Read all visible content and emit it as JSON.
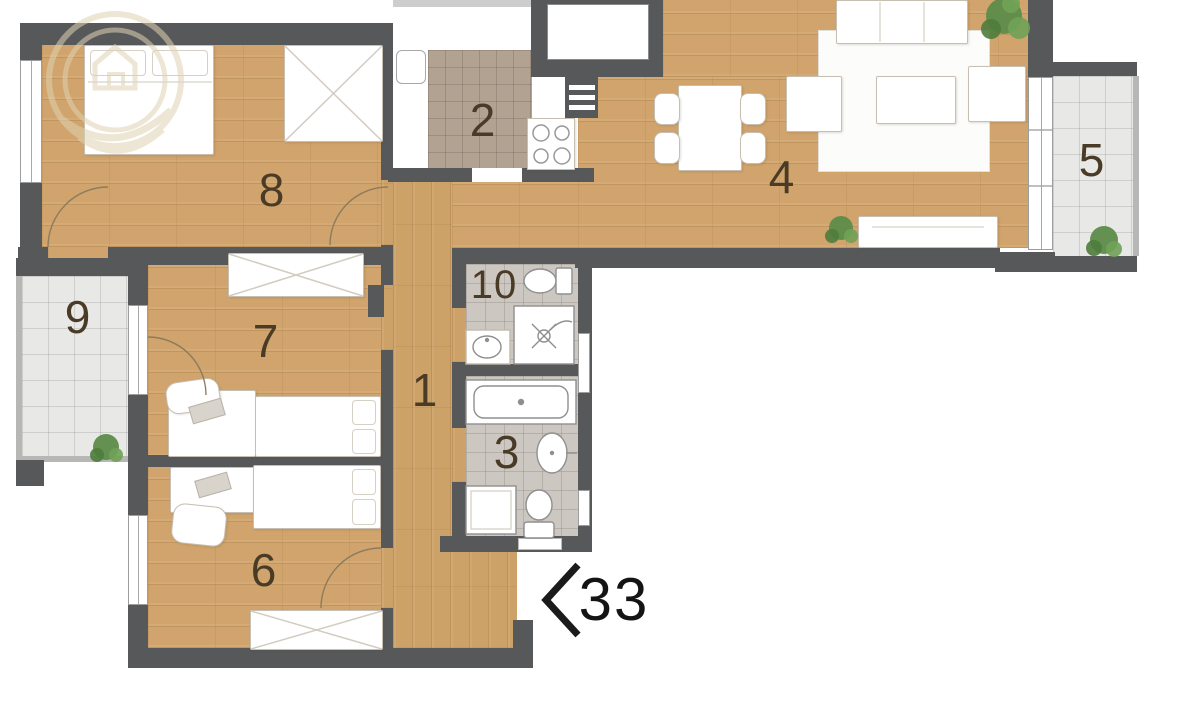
{
  "title": "Apartment floor plan",
  "unit": {
    "number": "33"
  },
  "rooms": [
    {
      "id": "hallway",
      "label": "1"
    },
    {
      "id": "kitchen",
      "label": "2"
    },
    {
      "id": "bathroom",
      "label": "3"
    },
    {
      "id": "living-room",
      "label": "4"
    },
    {
      "id": "balcony-right",
      "label": "5"
    },
    {
      "id": "bedroom-lower",
      "label": "6"
    },
    {
      "id": "bedroom-middle",
      "label": "7"
    },
    {
      "id": "bedroom-upper",
      "label": "8"
    },
    {
      "id": "balcony-left",
      "label": "9"
    },
    {
      "id": "wc-shower",
      "label": "10"
    }
  ],
  "colors": {
    "wall": "#57585a",
    "wood_floor": "#d0a46c",
    "kitchen_tile": "#b2a292",
    "bath_tile": "#ccc8c1",
    "balcony_tile": "#e8e8e6",
    "plant_green": "#61914d",
    "room_label": "#4a3b27",
    "unit_label": "#141414",
    "watermark": "#e0d3b4"
  }
}
